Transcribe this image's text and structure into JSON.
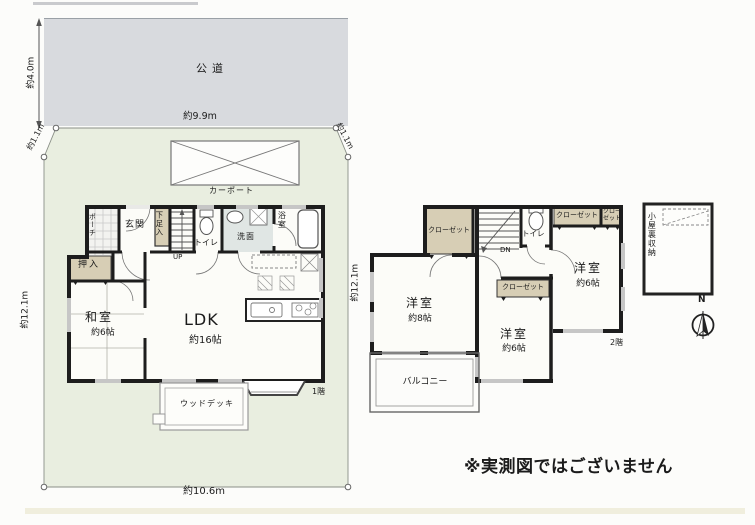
{
  "site": {
    "road_label": "公道",
    "carport_label": "カーポート",
    "wood_deck_label": "ウッドデッキ",
    "floor1_tag": "1階",
    "floor2_tag": "2階"
  },
  "dimensions": {
    "road_depth": "約4.0m",
    "road_width": "約9.9m",
    "corner_left": "約1.1m",
    "corner_right": "約1.1m",
    "site_depth_left": "約12.1m",
    "site_depth_right": "約12.1m",
    "site_width_bottom": "約10.6m"
  },
  "floor1": {
    "porch": "ポーチ",
    "entrance": "玄関",
    "shoe_box": "下足入",
    "stairs_up": "UP",
    "toilet": "トイレ",
    "washroom": "洗面",
    "bathroom": "浴室",
    "closet_oshiire": "押入",
    "japanese_room": "和室",
    "japanese_room_size": "約6帖",
    "ldk": "LDK",
    "ldk_size": "約16帖"
  },
  "floor2": {
    "closet_label": "クローゼット",
    "closet_vertical_line1": "クロー",
    "closet_vertical_line2": "ゼット",
    "stairs_down": "DN",
    "toilet": "トイレ",
    "bedroom_left": "洋室",
    "bedroom_left_size": "約8帖",
    "bedroom_mid": "洋室",
    "bedroom_mid_size": "約6帖",
    "bedroom_right": "洋室",
    "bedroom_right_size": "約6帖",
    "balcony": "バルコニー",
    "attic_storage": "小屋裏収納",
    "compass_north": "N"
  },
  "footer": {
    "disclaimer": "※実測図ではございません"
  },
  "colors": {
    "wall": "#1d1d1d",
    "closet_beige": "#d7ceb5",
    "road_gray": "#d8dade",
    "site_green": "#e9eee0",
    "washroom_tint": "#e0e6e4",
    "window_gray": "#c6c6c6"
  }
}
